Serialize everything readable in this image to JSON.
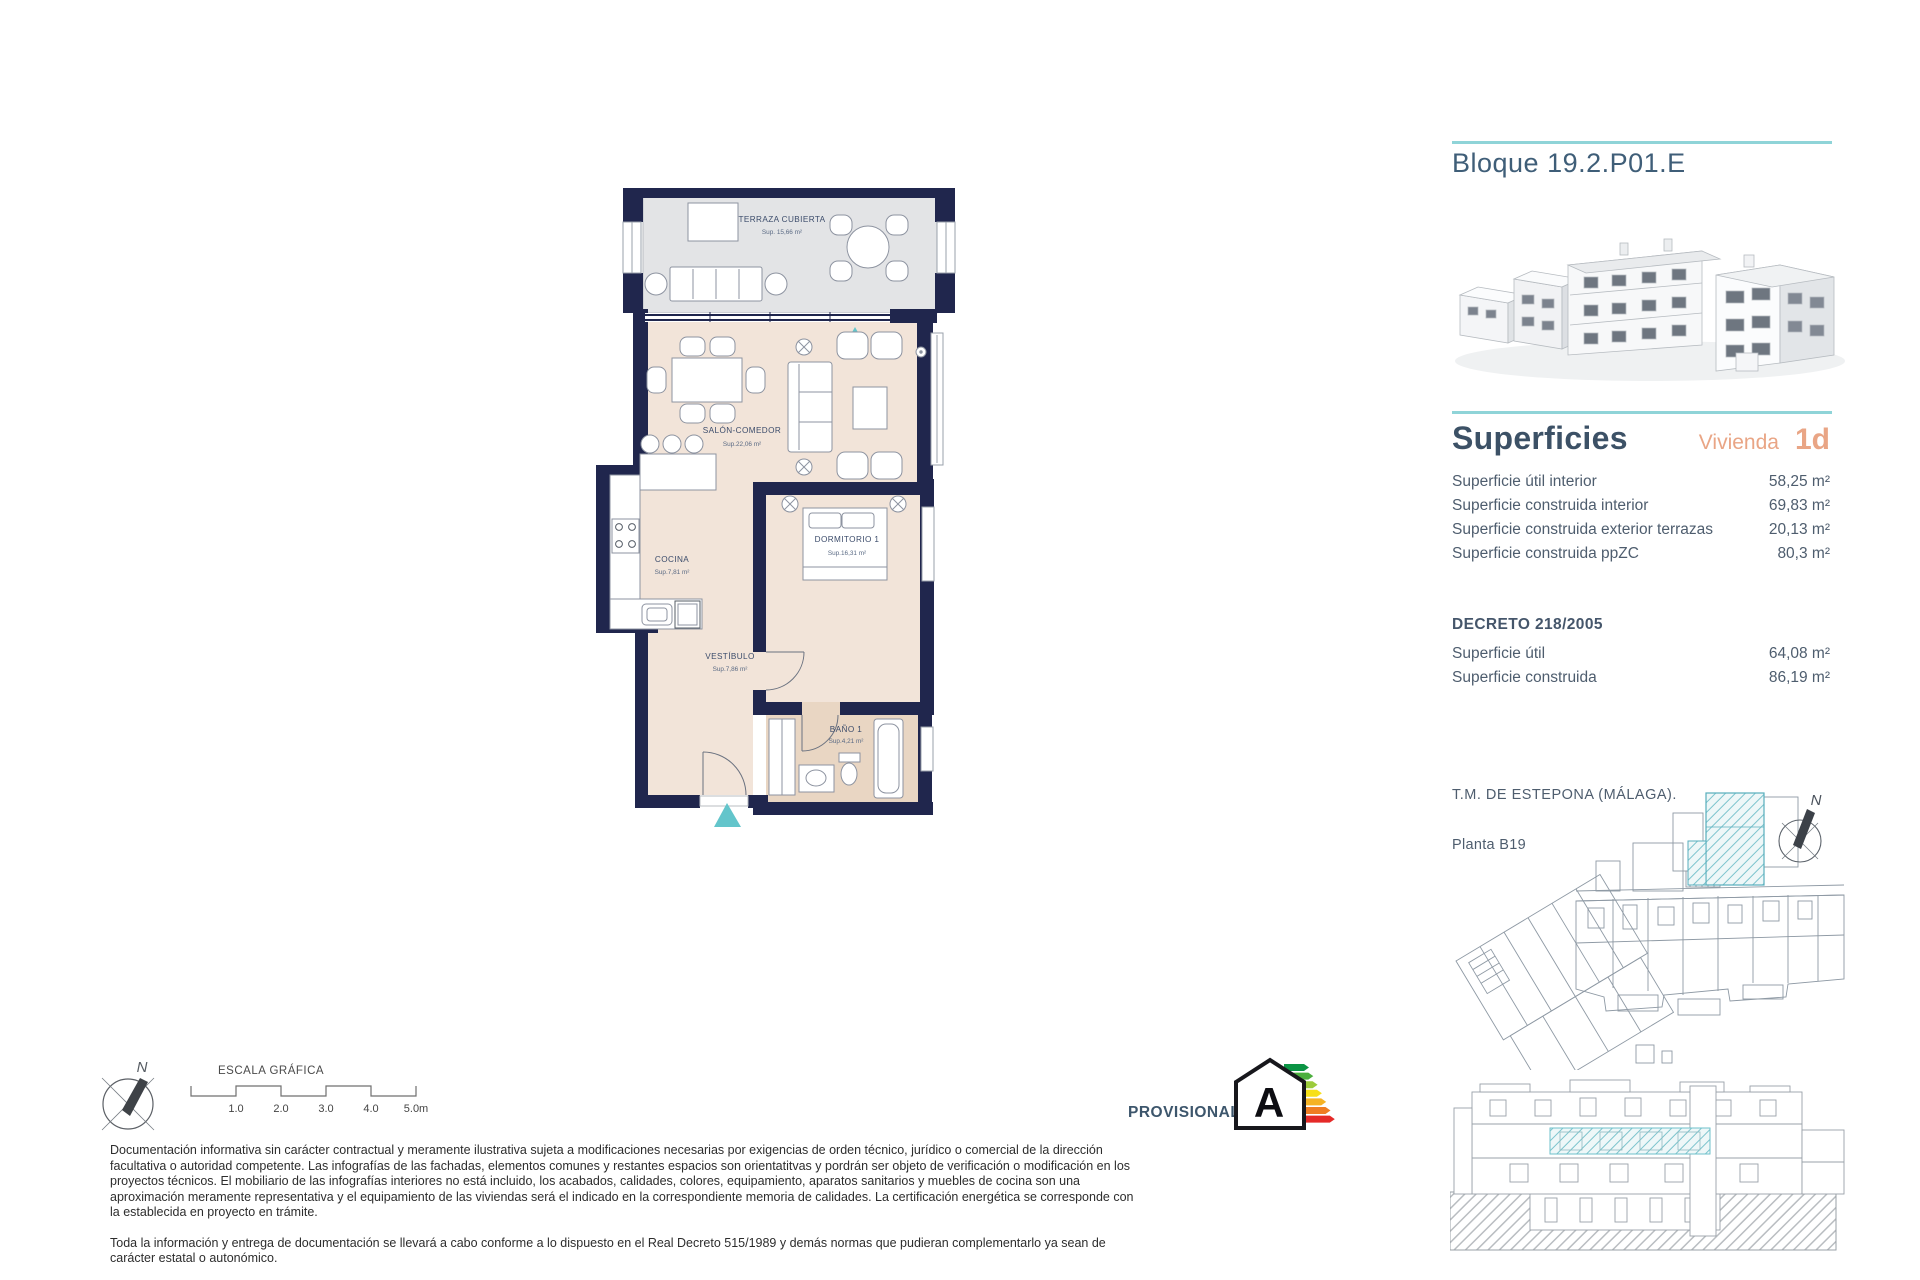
{
  "header": {
    "block_title": "Bloque 19.2.P01.E"
  },
  "superficies": {
    "title": "Superficies",
    "vivienda_label": "Vivienda",
    "vivienda_value": "1d",
    "rows": [
      {
        "label": "Superficie útil interior",
        "value": "58,25 m²"
      },
      {
        "label": "Superficie construida interior",
        "value": "69,83 m²"
      },
      {
        "label": "Superficie construida exterior terrazas",
        "value": "20,13 m²"
      },
      {
        "label": "Superficie construida ppZC",
        "value": "80,3 m²"
      }
    ],
    "decreto": {
      "title": "DECRETO 218/2005",
      "rows": [
        {
          "label": "Superficie útil",
          "value": "64,08 m²"
        },
        {
          "label": "Superficie construida",
          "value": "86,19 m²"
        }
      ]
    }
  },
  "location": {
    "municipality": "T.M. DE ESTEPONA (MÁLAGA).",
    "floor_label": "Planta B19",
    "compass_letter": "N"
  },
  "floorplan": {
    "compass_letter": "N",
    "rooms": [
      {
        "name": "TERRAZA CUBIERTA",
        "area": "Sup. 15,66 m²"
      },
      {
        "name": "SALÓN-COMEDOR",
        "area": "Sup.22,06 m²"
      },
      {
        "name": "COCINA",
        "area": "Sup.7,81 m²"
      },
      {
        "name": "DORMITORIO 1",
        "area": "Sup.16,31 m²"
      },
      {
        "name": "VESTÍBULO",
        "area": "Sup.7,86 m²"
      },
      {
        "name": "BAÑO 1",
        "area": "Sup.4,21 m²"
      }
    ]
  },
  "scale_bar": {
    "title": "ESCALA GRÁFICA",
    "tick_labels": [
      "1.0",
      "2.0",
      "3.0",
      "4.0",
      "5.0m"
    ]
  },
  "energy": {
    "status_label": "PROVISIONAL",
    "rating_letter": "A",
    "bar_colors": [
      "#0b9444",
      "#4caf3e",
      "#9ccb3b",
      "#f7e018",
      "#f5b325",
      "#ef7d23",
      "#e52a28"
    ]
  },
  "disclaimer": {
    "paragraph_1": "Documentación informativa sin carácter contractual y meramente ilustrativa sujeta a modificaciones necesarias por exigencias de orden técnico, jurídico o comercial de la dirección facultativa o autoridad competente. Las infografías de las fachadas, elementos comunes y restantes espacios son orientatitvas y pordrán ser objeto de verificación o modificación en los proyectos técnicos. El mobiliario de las infografías interiores no está incluido, los acabados, calidades, colores, equipamiento, aparatos sanitarios y muebles de cocina son una aproximación meramente representativa y el equipamiento de las viviendas será el indicado en la correspondiente memoria de calidades. La certificación energética se corresponde con la establecida en proyecto en trámite.",
    "paragraph_2": "Toda la información y entrega de documentación se llevará a cabo conforme a lo dispuesto en el Real Decreto 515/1989 y demás normas que pudieran complementarlo ya sean de carácter estatal o autonómico."
  },
  "colors": {
    "teal_accent": "#8fd4d8",
    "teal_marker": "#63c5cb",
    "orange_accent": "#e9a585",
    "wall_navy": "#20264d",
    "slate_heading": "#3f5e78"
  }
}
